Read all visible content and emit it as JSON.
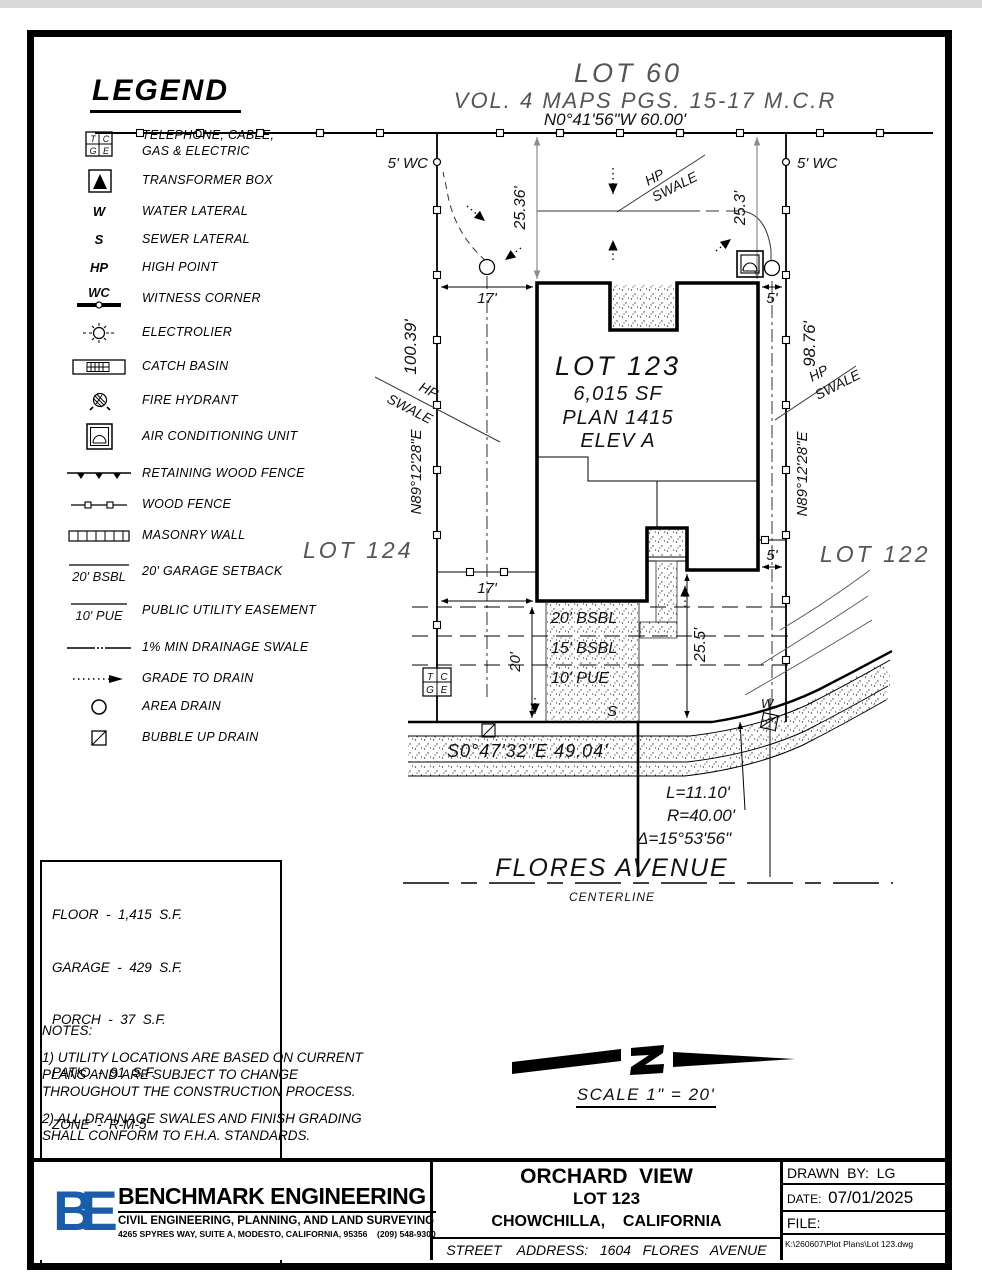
{
  "header": {
    "lot_above": "LOT 60",
    "map_ref": "VOL.  4  MAPS  PGS.  15-17  M.C.R"
  },
  "legend": {
    "title": "LEGEND",
    "items": [
      {
        "icon": "tcge-icon",
        "label": "TELEPHONE, CABLE,\nGAS & ELECTRIC"
      },
      {
        "icon": "transformer-box-icon",
        "label": "TRANSFORMER BOX"
      },
      {
        "icon": "water-lateral-icon",
        "symbol": "W",
        "label": "WATER LATERAL"
      },
      {
        "icon": "sewer-lateral-icon",
        "symbol": "S",
        "label": "SEWER LATERAL"
      },
      {
        "icon": "high-point-icon",
        "symbol": "HP",
        "label": "HIGH POINT"
      },
      {
        "icon": "witness-corner-icon",
        "symbol": "WC",
        "label": "WITNESS CORNER"
      },
      {
        "icon": "electrolier-icon",
        "label": "ELECTROLIER"
      },
      {
        "icon": "catch-basin-icon",
        "label": "CATCH BASIN"
      },
      {
        "icon": "fire-hydrant-icon",
        "label": "FIRE HYDRANT"
      },
      {
        "icon": "air-conditioning-unit-icon",
        "label": "AIR CONDITIONING UNIT"
      },
      {
        "icon": "retaining-wood-fence-icon",
        "label": "RETAINING WOOD FENCE"
      },
      {
        "icon": "wood-fence-icon",
        "label": "WOOD FENCE"
      },
      {
        "icon": "masonry-wall-icon",
        "label": "MASONRY WALL"
      },
      {
        "icon": "garage-setback-icon",
        "symbol": "20' BSBL",
        "label": "20' GARAGE SETBACK"
      },
      {
        "icon": "public-utility-easement-icon",
        "symbol": "10' PUE",
        "label": "PUBLIC UTILITY EASEMENT"
      },
      {
        "icon": "drainage-swale-icon",
        "label": "1% MIN DRAINAGE SWALE"
      },
      {
        "icon": "grade-to-drain-icon",
        "label": "GRADE TO DRAIN"
      },
      {
        "icon": "area-drain-icon",
        "label": "AREA DRAIN"
      },
      {
        "icon": "bubble-up-drain-icon",
        "label": "BUBBLE UP DRAIN"
      }
    ]
  },
  "symbols": {
    "t": "T",
    "c": "C",
    "g": "G",
    "e": "E"
  },
  "plot": {
    "bearing_top": "N0°41'56\"W   60.00'",
    "wc_label": "5' WC",
    "dim_25_36": "25.36'",
    "dim_25_3": "25.3'",
    "hp": "HP",
    "swale": "SWALE",
    "dim_17": "17'",
    "dim_5": "5'",
    "left_length": "100.39'",
    "side_bearing": "N89°12'28\"E",
    "right_length": "98.76'",
    "lot_124": "LOT 124",
    "lot_122": "LOT 122",
    "lot_name": "LOT 123",
    "lot_area": "6,015 SF",
    "lot_plan": "PLAN 1415",
    "lot_elev": "ELEV A",
    "bsbl_20": "20' BSBL",
    "bsbl_15": "15' BSBL",
    "pue_10": "10' PUE",
    "dim_20": "20'",
    "dim_25_5": "25.5'",
    "sewer_symbol": "S",
    "water_symbol": "W",
    "street_bearing": "S0°47'32\"E   49.04'",
    "curve_l": "L=11.10'",
    "curve_r": "R=40.00'",
    "curve_delta": "Δ=15°53'56\"",
    "street_name": "FLORES AVENUE",
    "centerline_label": "CENTERLINE"
  },
  "stats": {
    "rows": [
      "FLOOR  -  1,415  S.F.",
      "GARAGE  -  429  S.F.",
      "PORCH  -  37  S.F.",
      "PATIO  -  91  S.F.",
      "ZONE  -  R-M-5",
      "LOT  SQ.  FT.  6,015",
      "LOT  COVERAGE  -  31.3%"
    ]
  },
  "notes": {
    "title": "NOTES:",
    "items": [
      "1)  UTILITY  LOCATIONS  ARE  BASED  ON  CURRENT  PLANS AND  ARE  SUBJECT  TO  CHANGE  THROUGHOUT  THE CONSTRUCTION  PROCESS.",
      "2)  ALL  DRAINAGE  SWALES  AND  FINISH  GRADING  SHALL CONFORM  TO  F.H.A.  STANDARDS."
    ]
  },
  "scale": {
    "label": "SCALE  1\" = 20'"
  },
  "title_block": {
    "company": {
      "logo_text": "BE",
      "name": "BENCHMARK ENGINEERING",
      "tagline": "CIVIL ENGINEERING, PLANNING, AND LAND SURVEYING",
      "address": "4265 SPYRES WAY, SUITE A, MODESTO, CALIFORNIA, 95356    (209) 548-9300"
    },
    "project": {
      "name": "ORCHARD  VIEW",
      "lot": "LOT 123",
      "city": "CHOWCHILLA,    CALIFORNIA",
      "street_address": "STREET    ADDRESS:   1604   FLORES   AVENUE"
    },
    "drawn_by": "DRAWN  BY:  LG",
    "date_label": "DATE:",
    "date": "07/01/2025",
    "file_label": "FILE:",
    "file_path": "K:\\260607\\Plot Plans\\Lot 123.dwg"
  },
  "colors": {
    "accent_blue": "#1a5dab",
    "line": "#000000",
    "dim_gray": "#8c8c8c"
  }
}
